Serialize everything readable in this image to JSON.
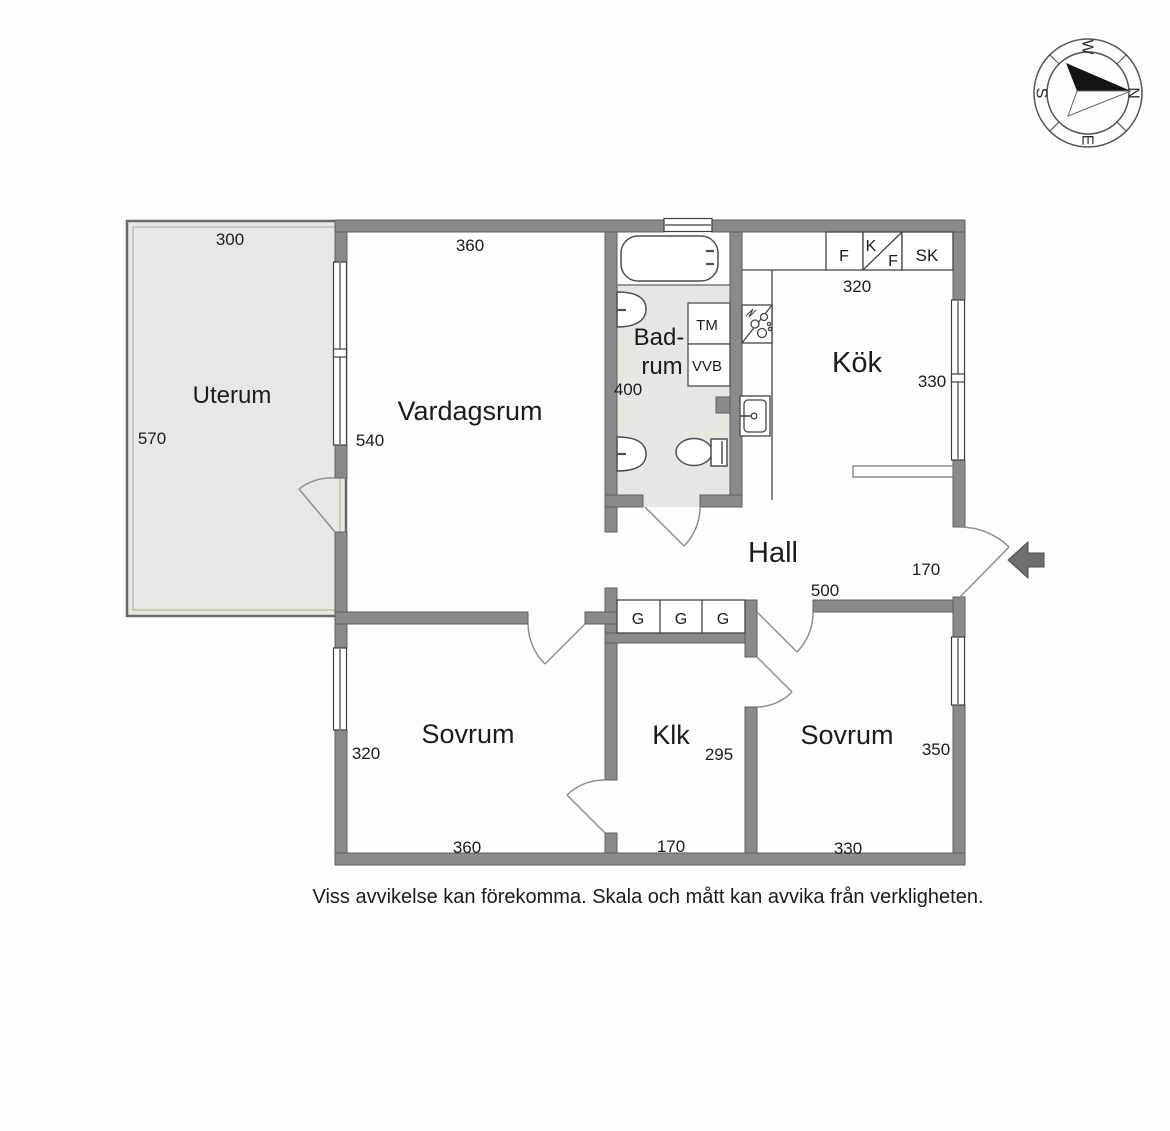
{
  "compass": {
    "north": "N",
    "east": "E",
    "south": "S",
    "west": "W"
  },
  "rooms": {
    "uterum": {
      "name": "Uterum",
      "width": "300",
      "height": "570"
    },
    "vardagsrum": {
      "name": "Vardagsrum",
      "width": "360",
      "height": "540"
    },
    "badrum": {
      "name_line1": "Bad-",
      "name_line2": "rum",
      "width": "400",
      "appliances": {
        "tm": "TM",
        "vvb": "VVB"
      }
    },
    "kok": {
      "name": "Kök",
      "depth": "330",
      "cabinet_width": "320",
      "cabinets": [
        "F",
        "K",
        "F",
        "SK"
      ]
    },
    "hall": {
      "name": "Hall",
      "width": "500",
      "entry_width": "170",
      "wardrobes": [
        "G",
        "G",
        "G"
      ]
    },
    "sovrum_left": {
      "name": "Sovrum",
      "height": "320",
      "width": "360"
    },
    "klk": {
      "name": "Klk",
      "height": "295",
      "width": "170"
    },
    "sovrum_right": {
      "name": "Sovrum",
      "height": "350",
      "width": "330"
    }
  },
  "disclaimer": "Viss avvikelse kan förekomma. Skala och mått kan avvika från verkligheten.",
  "colors": {
    "wall": "#8a8a8a",
    "uterum_fill": "#eae7e2",
    "badrum_fill": "#e9e6e1"
  }
}
